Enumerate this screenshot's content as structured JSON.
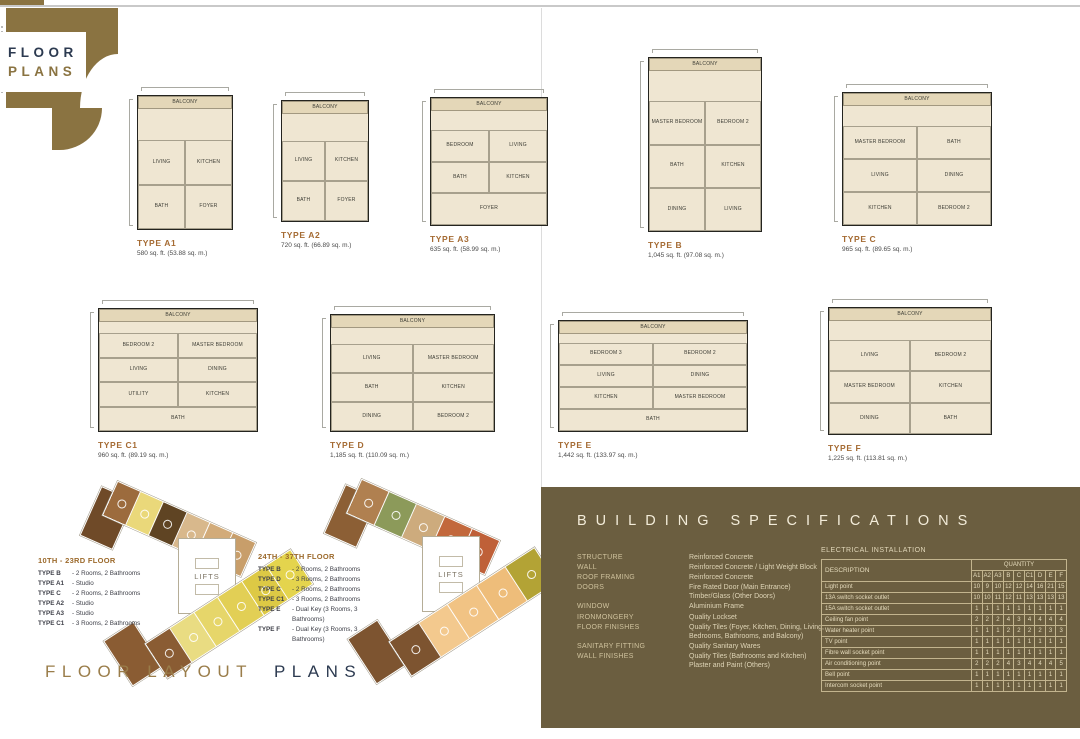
{
  "brand": {
    "line1": "FLOOR",
    "line2": "PLANS"
  },
  "footer": {
    "part1": "FLOOR LAYOUT",
    "part2": "PLANS"
  },
  "colors": {
    "brand_gold": "#8a7341",
    "type_label": "#a56b33",
    "navy": "#2c3a50",
    "panel_bg": "#6b5e40",
    "plan_fill": "#efe6d2"
  },
  "plans": [
    {
      "name": "TYPE A1",
      "area": "580 sq. ft. (53.88 sq. m.)",
      "rooms": [
        "BALCONY",
        "LIVING",
        "KITCHEN",
        "BATH",
        "FOYER"
      ]
    },
    {
      "name": "TYPE A2",
      "area": "720 sq. ft. (66.89 sq. m.)",
      "rooms": [
        "BALCONY",
        "LIVING",
        "KITCHEN",
        "BATH",
        "FOYER"
      ]
    },
    {
      "name": "TYPE A3",
      "area": "635 sq. ft. (58.99 sq. m.)",
      "rooms": [
        "BALCONY",
        "BEDROOM",
        "LIVING",
        "BATH",
        "KITCHEN",
        "FOYER"
      ]
    },
    {
      "name": "TYPE B",
      "area": "1,045 sq. ft. (97.08 sq. m.)",
      "rooms": [
        "BALCONY",
        "MASTER BEDROOM",
        "BEDROOM 2",
        "BATH",
        "KITCHEN",
        "DINING",
        "LIVING"
      ]
    },
    {
      "name": "TYPE C",
      "area": "965 sq. ft. (89.65 sq. m.)",
      "rooms": [
        "BALCONY",
        "MASTER BEDROOM",
        "BATH",
        "LIVING",
        "DINING",
        "KITCHEN",
        "BEDROOM 2"
      ]
    },
    {
      "name": "TYPE C1",
      "area": "960 sq. ft. (89.19 sq. m.)",
      "rooms": [
        "BALCONY",
        "BEDROOM 2",
        "MASTER BEDROOM",
        "LIVING",
        "DINING",
        "UTILITY",
        "KITCHEN",
        "BATH"
      ]
    },
    {
      "name": "TYPE D",
      "area": "1,185 sq. ft. (110.09 sq. m.)",
      "rooms": [
        "BALCONY",
        "LIVING",
        "MASTER BEDROOM",
        "BATH",
        "KITCHEN",
        "DINING",
        "BEDROOM 2"
      ]
    },
    {
      "name": "TYPE E",
      "area": "1,442 sq. ft. (133.97 sq. m.)",
      "rooms": [
        "BALCONY",
        "BEDROOM 3",
        "BEDROOM 2",
        "LIVING",
        "DINING",
        "KITCHEN",
        "MASTER BEDROOM",
        "BATH"
      ]
    },
    {
      "name": "TYPE F",
      "area": "1,225 sq. ft. (113.81 sq. m.)",
      "rooms": [
        "BALCONY",
        "LIVING",
        "BEDROOM 2",
        "MASTER BEDROOM",
        "KITCHEN",
        "DINING",
        "BATH"
      ]
    }
  ],
  "layouts": [
    {
      "title": "10TH - 23RD FLOOR",
      "lifts_label": "LIFTS",
      "legend": [
        {
          "type": "TYPE B",
          "desc": "- 2 Rooms, 2 Bathrooms"
        },
        {
          "type": "TYPE A1",
          "desc": "- Studio"
        },
        {
          "type": "TYPE C",
          "desc": "- 2 Rooms, 2 Bathrooms"
        },
        {
          "type": "TYPE A2",
          "desc": "- Studio"
        },
        {
          "type": "TYPE A3",
          "desc": "- Studio"
        },
        {
          "type": "TYPE C1",
          "desc": "- 3 Rooms, 2 Bathrooms"
        }
      ],
      "top_wing": [
        "#9c6b3d",
        "#ead87a",
        "#5f4423",
        "#d8b88c",
        "#d2ab79",
        "#c89e6a"
      ],
      "bottom_wing": [
        "#8a5c33",
        "#e9dc82",
        "#e6d66a",
        "#e2cf55",
        "#ddc945",
        "#e4d44d"
      ],
      "top_end": "#6f4a28",
      "bottom_end": "#8a5c33"
    },
    {
      "title": "24TH - 37TH FLOOR",
      "lifts_label": "LIFTS",
      "legend": [
        {
          "type": "TYPE B",
          "desc": "- 2 Rooms, 2 Bathrooms"
        },
        {
          "type": "TYPE D",
          "desc": "- 3 Rooms, 2 Bathrooms"
        },
        {
          "type": "TYPE C",
          "desc": "- 2 Rooms, 2 Bathrooms"
        },
        {
          "type": "TYPE C1",
          "desc": "- 3 Rooms, 2 Bathrooms"
        },
        {
          "type": "TYPE E",
          "desc": "- Dual Key (3 Rooms, 3 Bathrooms)"
        },
        {
          "type": "TYPE F",
          "desc": "- Dual Key (3 Rooms, 3 Bathrooms)"
        }
      ],
      "top_wing": [
        "#b08050",
        "#8c9a5a",
        "#cdab7d",
        "#c2683c",
        "#bf6038"
      ],
      "bottom_wing": [
        "#7d5430",
        "#f3c98e",
        "#f1c384",
        "#eebd7a",
        "#b3a335"
      ],
      "top_end": "#8c5f35",
      "bottom_end": "#7d5430"
    }
  ],
  "specs": {
    "title": "BUILDING SPECIFICATIONS",
    "items": [
      {
        "label": "STRUCTURE",
        "lines": [
          "Reinforced Concrete"
        ]
      },
      {
        "label": "WALL",
        "lines": [
          "Reinforced Concrete / Light Weight Block"
        ]
      },
      {
        "label": "ROOF FRAMING",
        "lines": [
          "Reinforced Concrete"
        ]
      },
      {
        "label": "DOORS",
        "lines": [
          "Fire Rated Door (Main Entrance)",
          "Timber/Glass (Other Doors)"
        ]
      },
      {
        "label": "WINDOW",
        "lines": [
          "Aluminium Frame"
        ]
      },
      {
        "label": "IRONMONGERY",
        "lines": [
          "Quality Lockset"
        ]
      },
      {
        "label": "FLOOR FINISHES",
        "lines": [
          "Quality Tiles (Foyer, Kitchen, Dining, Living,",
          "Bedrooms, Bathrooms, and Balcony)"
        ]
      },
      {
        "label": "SANITARY FITTING",
        "lines": [
          "Quality Sanitary Wares"
        ]
      },
      {
        "label": "WALL FINISHES",
        "lines": [
          "Quality Tiles (Bathrooms and Kitchen)",
          "Plaster and Paint (Others)"
        ]
      }
    ],
    "electrical": {
      "title": "ELECTRICAL INSTALLATION",
      "desc_header": "DESCRIPTION",
      "qty_header": "QUANTITY",
      "unit_cols": [
        "A1",
        "A2",
        "A3",
        "B",
        "C",
        "C1",
        "D",
        "E",
        "F"
      ],
      "rows": [
        {
          "label": "Light point",
          "values": [
            10,
            9,
            10,
            12,
            12,
            14,
            16,
            21,
            15
          ]
        },
        {
          "label": "13A switch socket outlet",
          "values": [
            10,
            10,
            11,
            12,
            11,
            13,
            13,
            13,
            13
          ]
        },
        {
          "label": "15A switch socket outlet",
          "values": [
            1,
            1,
            1,
            1,
            1,
            1,
            1,
            1,
            1
          ]
        },
        {
          "label": "Ceiling fan point",
          "values": [
            2,
            2,
            2,
            4,
            3,
            4,
            4,
            4,
            4
          ]
        },
        {
          "label": "Water heater point",
          "values": [
            1,
            1,
            1,
            2,
            2,
            2,
            2,
            3,
            3
          ]
        },
        {
          "label": "TV point",
          "values": [
            1,
            1,
            1,
            1,
            1,
            1,
            1,
            1,
            1
          ]
        },
        {
          "label": "Fibre wall socket point",
          "values": [
            1,
            1,
            1,
            1,
            1,
            1,
            1,
            1,
            1
          ]
        },
        {
          "label": "Air conditioning point",
          "values": [
            2,
            2,
            2,
            4,
            3,
            4,
            4,
            4,
            5
          ]
        },
        {
          "label": "Bell point",
          "values": [
            1,
            1,
            1,
            1,
            1,
            1,
            1,
            1,
            1
          ]
        },
        {
          "label": "Intercom socket point",
          "values": [
            1,
            1,
            1,
            1,
            1,
            1,
            1,
            1,
            1
          ]
        }
      ]
    }
  }
}
